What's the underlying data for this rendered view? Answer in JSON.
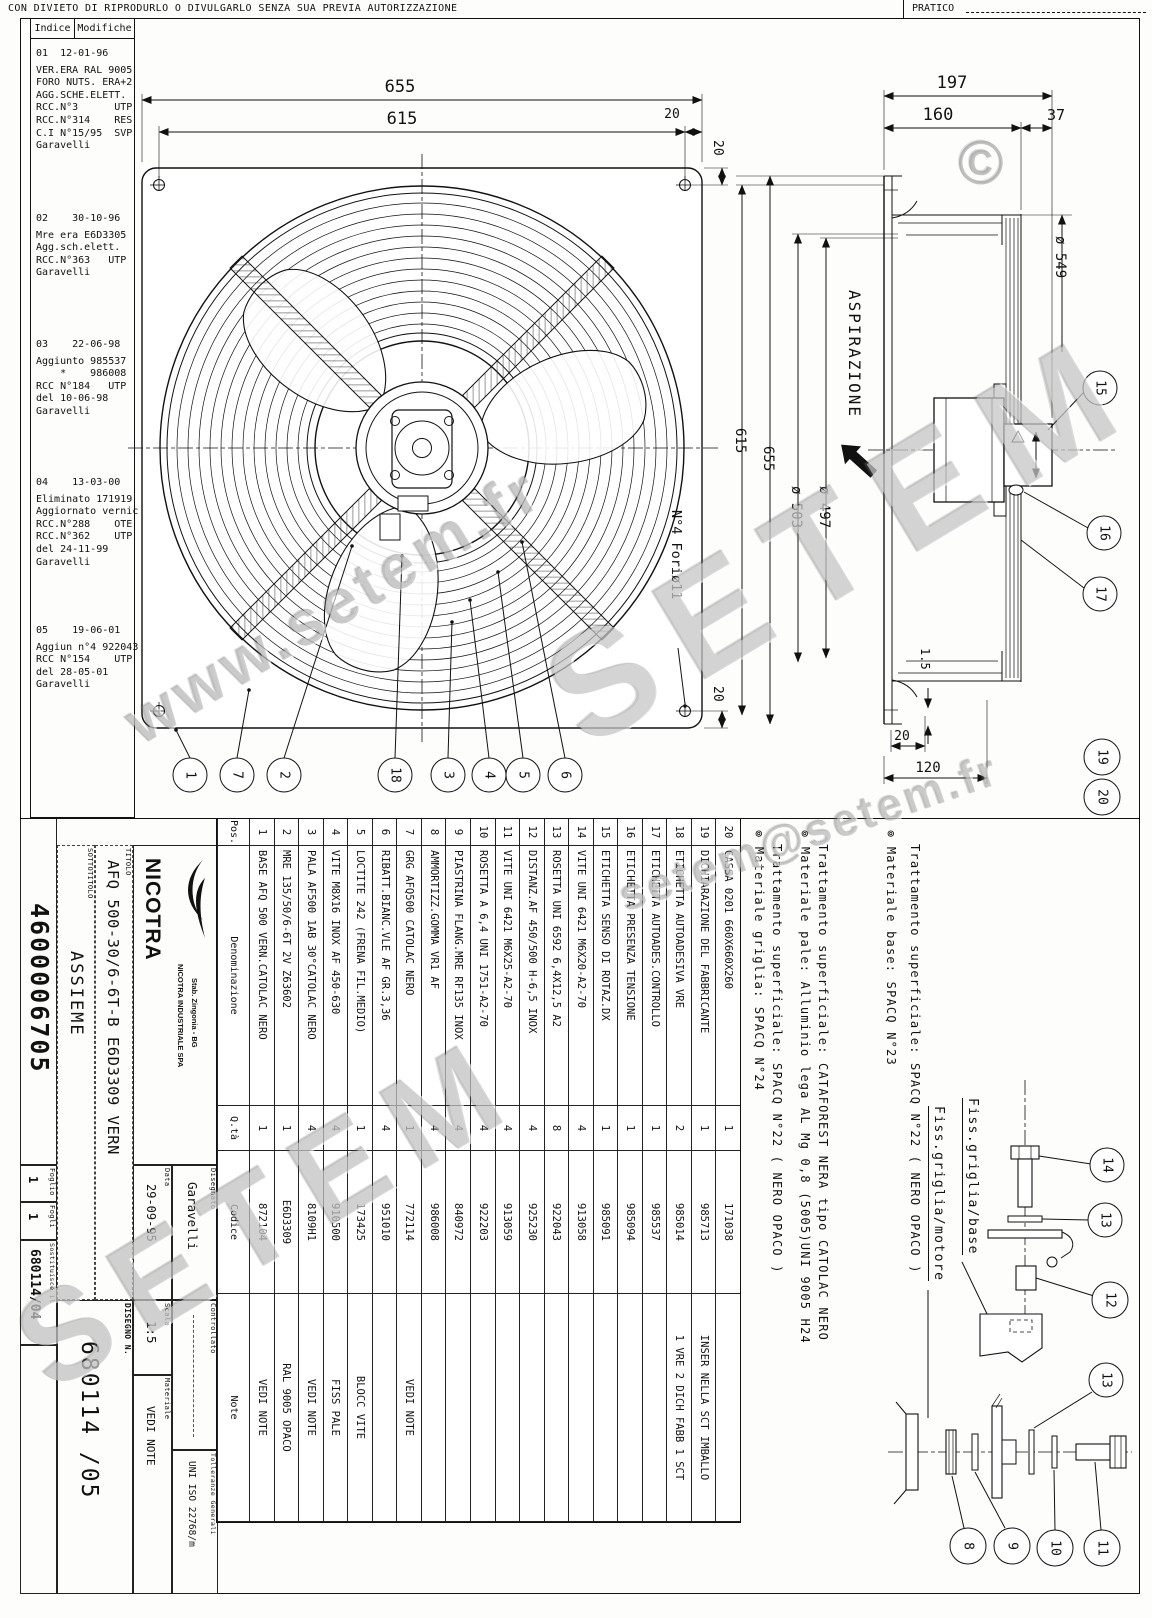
{
  "banner": {
    "text": "CON DIVIETO DI RIPRODURLO O DIVULGARLO SENZA SUA PREVIA AUTORIZZAZIONE",
    "pratico_label": "PRATICO"
  },
  "revision_table": {
    "header": {
      "indice": "Indice",
      "modifiche": "Modifiche"
    },
    "entries": [
      {
        "no": "01",
        "date": "12-01-96",
        "body": "VER.ERA RAL 9005\nFORO NUTS. ERA+2\nAGG.SCHE.ELETT.\nRCC.N°3      UTP\nRCC.N°314    RES\nC.I N°15/95  SVP\nGaravelli"
      },
      {
        "no": "02",
        "date": "30-10-96",
        "body": "Mre era E6D3305\nAgg.sch.elett.\nRCC.N°363   UTP\nGaravelli"
      },
      {
        "no": "03",
        "date": "22-06-98",
        "body": "Aggiunto 985537\n    *    986008\nRCC N°184   UTP\ndel 10-06-98\nGaravelli"
      },
      {
        "no": "04",
        "date": "13-03-00",
        "body": "Eliminato 171919\nAggiornato vernic\nRCC.N°288    OTE\nRCC.N°362    UTP\ndel 24-11-99\nGaravelli"
      },
      {
        "no": "05",
        "date": "19-06-01",
        "body": "Aggiun n°4 922043\nRCC N°154    UTP\ndel 28-05-01\nGaravelli"
      }
    ]
  },
  "dims": {
    "front_width": "655",
    "front_holes": "615",
    "front_edge": "20",
    "front_edge_top": "20",
    "front_edge_bottom": "20",
    "fori": "N°4 Foriø11",
    "depth_total": "197",
    "depth_body": "160",
    "depth_box": "37",
    "ring_od": "ø 549",
    "side_height": "655",
    "side_holes": "615",
    "d503": "ø 503",
    "d497": "ø 497",
    "aspirazione": "ASPIRAZIONE",
    "flange": "1.5",
    "foot": "20",
    "foot_total": "120"
  },
  "balloons": {
    "n1": "1",
    "n2": "2",
    "n3": "3",
    "n4": "4",
    "n5": "5",
    "n6": "6",
    "n7": "7",
    "n8": "8",
    "n9": "9",
    "n10": "10",
    "n11": "11",
    "n12": "12",
    "n13": "13",
    "n14": "14",
    "n15": "15",
    "n16": "16",
    "n17": "17",
    "n18": "18",
    "n19": "19",
    "n20": "20"
  },
  "bom": {
    "headers": {
      "pos": "Pos.",
      "den": "Denominazione",
      "qta": "Q.tà",
      "cod": "Codice",
      "note": "Note"
    },
    "rows": [
      {
        "pos": "20",
        "den": "CASSA 0201 660X660X260",
        "qta": "1",
        "cod": "171038",
        "note": ""
      },
      {
        "pos": "19",
        "den": "DICHIARAZIONE DEL FABBRICANTE",
        "qta": "1",
        "cod": "985713",
        "note": "INSER NELLA SCT IMBALLO"
      },
      {
        "pos": "18",
        "den": "ETICHETTA AUTOADESIVA VRE",
        "qta": "2",
        "cod": "985014",
        "note": "1 VRE 2 DICH FABB 1 SCT"
      },
      {
        "pos": "17",
        "den": "ETICHETTA AUTOADES.CONTROLLO",
        "qta": "1",
        "cod": "985537",
        "note": ""
      },
      {
        "pos": "16",
        "den": "ETICHETTA PRESENZA TENSIONE",
        "qta": "1",
        "cod": "985094",
        "note": ""
      },
      {
        "pos": "15",
        "den": "ETICHETTA SENSO DI ROTAZ.DX",
        "qta": "1",
        "cod": "985091",
        "note": ""
      },
      {
        "pos": "14",
        "den": "VITE UNI 6421 M6X20-A2-70",
        "qta": "4",
        "cod": "913058",
        "note": ""
      },
      {
        "pos": "13",
        "den": "ROSETTA UNI 6592 6,4X12,5 A2",
        "qta": "8",
        "cod": "922043",
        "note": ""
      },
      {
        "pos": "12",
        "den": "DISTANZ.AF 450/500 H-6,5 INOX",
        "qta": "4",
        "cod": "925230",
        "note": ""
      },
      {
        "pos": "11",
        "den": "VITE UNI 6421 M6X25-A2-70",
        "qta": "4",
        "cod": "913059",
        "note": ""
      },
      {
        "pos": "10",
        "den": "ROSETTA A 6,4 UNI 1751-A2-70",
        "qta": "4",
        "cod": "922203",
        "note": ""
      },
      {
        "pos": "9",
        "den": "PIASTRINA FLANG.MRE RF135 INOX",
        "qta": "4",
        "cod": "840972",
        "note": ""
      },
      {
        "pos": "8",
        "den": "AMMORTIZZ.GOMMA VR1 AF",
        "qta": "4",
        "cod": "986008",
        "note": ""
      },
      {
        "pos": "7",
        "den": "GRG AFQ500 CATOLAC NERO",
        "qta": "1",
        "cod": "772114",
        "note": "VEDI NOTE"
      },
      {
        "pos": "6",
        "den": "RIBATT.BIANC.VLE AF GR.3,36",
        "qta": "4",
        "cod": "951010",
        "note": ""
      },
      {
        "pos": "5",
        "den": "LOCTITE 242 (FRENA FIL.MEDIO)",
        "qta": "1",
        "cod": "173425",
        "note": "BLOCC VITE"
      },
      {
        "pos": "4",
        "den": "VITE M8X16 INOX AF 450-630",
        "qta": "4",
        "cod": "910500",
        "note": "FISS PALE"
      },
      {
        "pos": "3",
        "den": "PALA AF500 1AB 30°CATOLAC NERO",
        "qta": "4",
        "cod": "8109H1",
        "note": "VEDI NOTE"
      },
      {
        "pos": "2",
        "den": "MRE 135/50/6-6T 2V Z63602",
        "qta": "1",
        "cod": "E6D3309",
        "note": "RAL 9005 OPACO"
      },
      {
        "pos": "1",
        "den": "BASE AFQ 500 VERN.CATOLAC NERO",
        "qta": "1",
        "cod": "872104",
        "note": "VEDI NOTE"
      }
    ]
  },
  "material_notes": {
    "items": [
      {
        "l1": "⊚ Materiale griglia: SPACQ N°24",
        "l2": "Trattamento superficiale: SPACQ N°22 ( NERO OPACO )"
      },
      {
        "l1": "⊚ Materiale pale: Alluminio lega AL Mg 0,8 (5005)UNI 9005 H24",
        "l2": "Trattamento superficiale: CATAFOREST NERA tipo CATOLAC NERO"
      },
      {
        "l1": "⊚ Materiale base: SPACQ N°23",
        "l2": "Trattamento superficiale: SPACQ N°22 ( NERO OPACO )"
      }
    ]
  },
  "details": {
    "fiss_base": "Fiss.griglia/base",
    "fiss_motore": "Fiss.griglia/motore"
  },
  "title_block": {
    "codice_interno": "4600006705",
    "foglio_label": "Foglio",
    "foglio": "1",
    "fogli_label": "Fogli",
    "fogli": "1",
    "sostituisce_label": "Sostituisce il",
    "sostituisce": "680114/04",
    "sottotitolo_label": "SOTTOTITOLO",
    "sottotitolo": "ASSIEME",
    "titolo_label": "TITOLO",
    "titolo": "AFQ 500-30/6-6T-B E6D3309 VERN",
    "company": "NICOTRA",
    "company_line1": "NICOTRA INDUSTRIALE SPA",
    "company_line2": "Stab. Zingonia - BG",
    "data_label": "Data",
    "data": "29-09-95",
    "disegnato_label": "Disegnato",
    "disegnato": "Garavelli",
    "scala_label": "Scala",
    "scala": "1:5",
    "materiale_label": "Materiale",
    "materiale": "VEDI NOTE",
    "controllato_label": "Controllato",
    "tolleranze_label": "Tolleranze Generali",
    "tolleranze": "UNI ISO 22768/m",
    "disegno_label": "DISEGNO N.",
    "disegno": "680114 /05"
  },
  "watermarks": {
    "site": "www.setem.fr",
    "brand": "SETEM",
    "email": "setem@setem.fr",
    "copyright": "©"
  }
}
